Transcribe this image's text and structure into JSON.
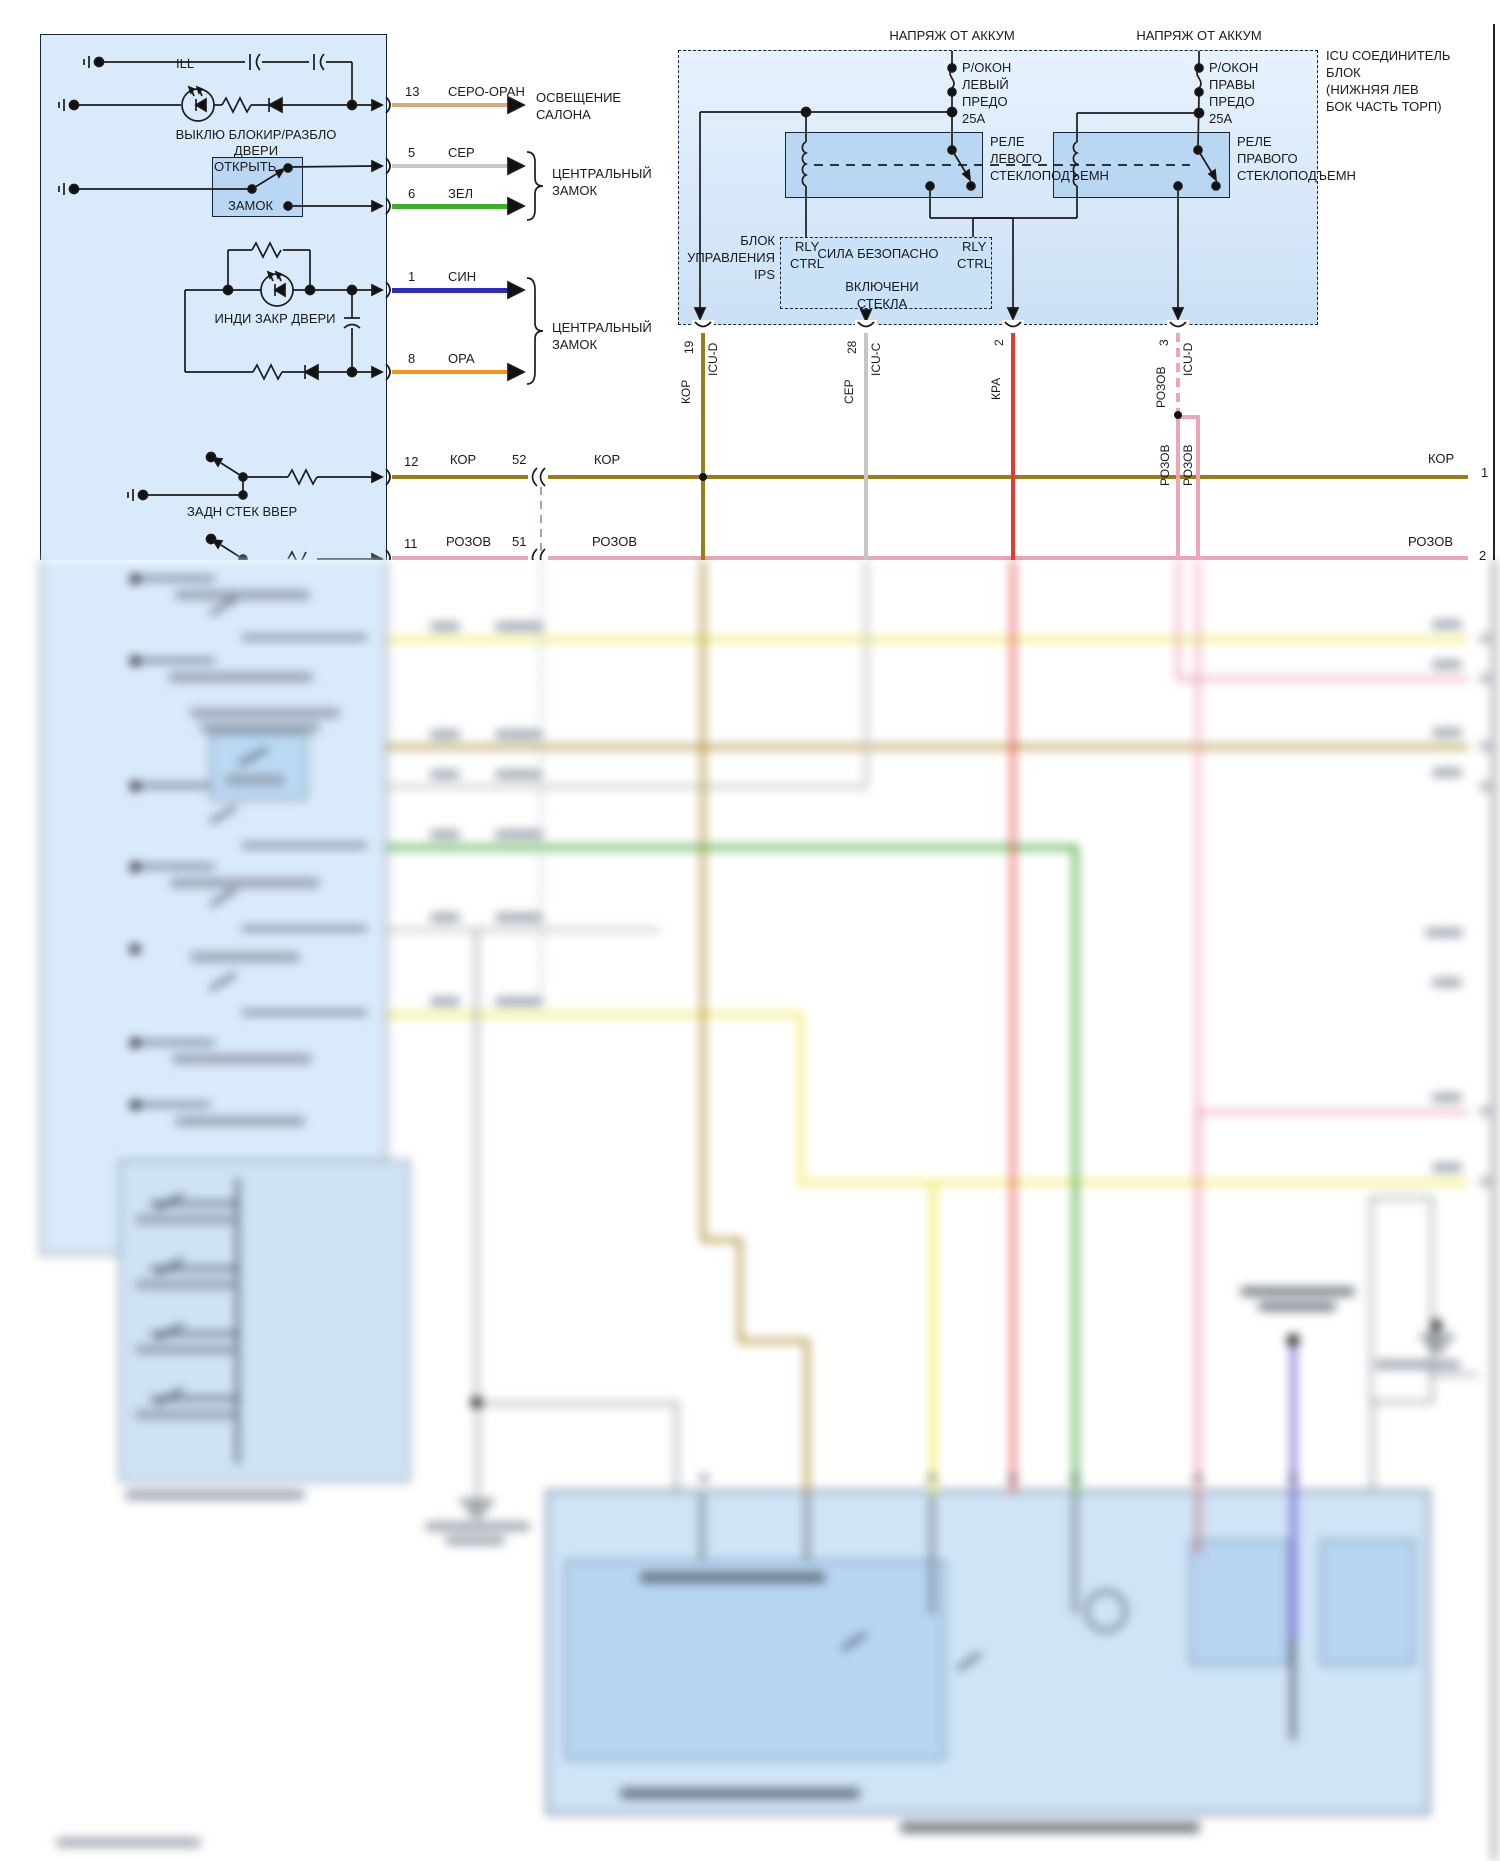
{
  "left_block": {
    "ill_label": "ILL",
    "switch_title_l1": "ВЫКЛЮ БЛОКИР/РАЗБЛО",
    "switch_title_l2": "ДВЕРИ",
    "unlock_label": "ОТКРЫТЬ",
    "lock_label": "ЗАМОК",
    "indicator_label": "ИНДИ ЗАКР ДВЕРИ",
    "rear_window_switch_label": "ЗАДН СТЕК ВВЕР"
  },
  "pins": {
    "p13": {
      "num": "13",
      "wire": "СЕРО-ОРАН"
    },
    "p5": {
      "num": "5",
      "wire": "СЕР"
    },
    "p6": {
      "num": "6",
      "wire": "ЗЕЛ"
    },
    "p1": {
      "num": "1",
      "wire": "СИН"
    },
    "p8": {
      "num": "8",
      "wire": "ОРА"
    },
    "p12": {
      "num": "12",
      "wire": "КОР"
    },
    "p11": {
      "num": "11",
      "wire": "РОЗОВ"
    }
  },
  "destinations": {
    "interior_light_l1": "ОСВЕЩЕНИЕ",
    "interior_light_l2": "САЛОНА",
    "central_lock_l1": "ЦЕНТРАЛЬНЫЙ",
    "central_lock_l2": "ЗАМОК"
  },
  "connectors": {
    "c52": "52",
    "c52_wire": "КОР",
    "c51": "51",
    "c51_wire": "РОЗОВ",
    "right_kor": "КОР",
    "right_kor_pin": "1",
    "right_rozov": "РОЗОВ",
    "right_rozov_pin": "2"
  },
  "icu": {
    "battery_left": "НАПРЯЖ ОТ АККУМ",
    "battery_right": "НАПРЯЖ ОТ АККУМ",
    "fuse_left": [
      "Р/ОКОН",
      "ЛЕВЫЙ",
      "ПРЕДО",
      "25A"
    ],
    "fuse_right": [
      "Р/ОКОН",
      "ПРАВЫ",
      "ПРЕДО",
      "25A"
    ],
    "relay_left": [
      "РЕЛЕ",
      "ЛЕВОГО",
      "СТЕКЛОПОДЪЕМН"
    ],
    "relay_right": [
      "РЕЛЕ",
      "ПРАВОГО",
      "СТЕКЛОПОДЪЕМН"
    ],
    "ips": [
      "БЛОК",
      "УПРАВЛЕНИЯ",
      "IPS"
    ],
    "rly_left_l1": "RLY",
    "rly_left_l2": "CTRL",
    "rly_right_l1": "RLY",
    "rly_right_l2": "CTRL",
    "safety_power": "СИЛА БЕЗОПАСНО",
    "window_on_l1": "ВКЛЮЧЕНИ",
    "window_on_l2": "СТЕКЛА",
    "side_note": [
      "ICU СОЕДИНИТЕЛЬ",
      "БЛОК",
      "(НИЖНЯЯ ЛЕВ",
      "БОК ЧАСТЬ ТОРП)"
    ],
    "pin19": {
      "num": "19",
      "conn": "ICU-D",
      "wire": "КОР"
    },
    "pin28": {
      "num": "28",
      "conn": "ICU-C",
      "wire": "СЕР"
    },
    "pin2": {
      "num": "2",
      "wire": "КРА"
    },
    "pin3": {
      "num": "3",
      "conn": "ICU-D",
      "wire": "РОЗОВ"
    },
    "rozov_branch_1": "РОЗОВ",
    "rozov_branch_2": "РОЗОВ"
  },
  "colors": {
    "block_fill": "#d9ebfb",
    "inner_box_fill": "#b9d7f2",
    "icu_fill": "#d5e7f9",
    "gray_orange": "#d9a87c",
    "gray": "#c6c6c6",
    "green": "#3fae2a",
    "blue": "#2b2bc4",
    "orange": "#f5941f",
    "brown_kor": "#9b7c16",
    "pink_rozov": "#eba6b8",
    "red_kra": "#e03c31",
    "yellow": "#f2ee79",
    "violet": "#6c5ccf"
  }
}
